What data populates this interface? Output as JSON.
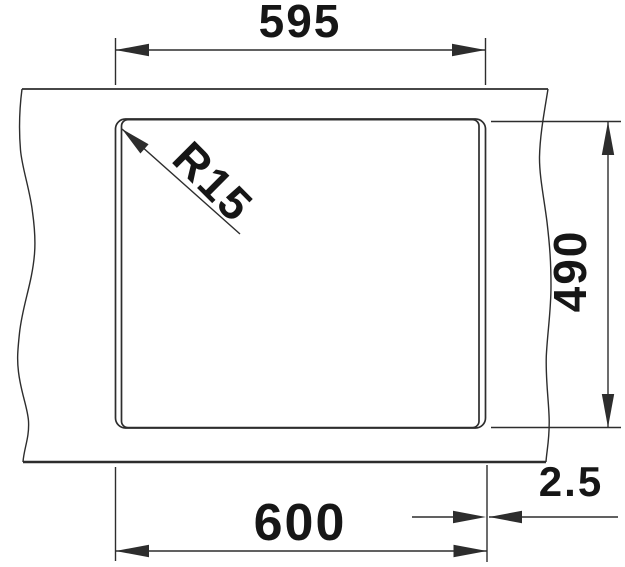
{
  "drawing": {
    "kind": "technical-dimension-drawing-top-view",
    "labels": {
      "top_width": "595",
      "right_height": "490",
      "bottom_width": "600",
      "side_offset": "2.5",
      "corner_radius": "R15"
    },
    "colors": {
      "background": "#ffffff",
      "line": "#2d2d2d",
      "text": "#161616"
    }
  }
}
